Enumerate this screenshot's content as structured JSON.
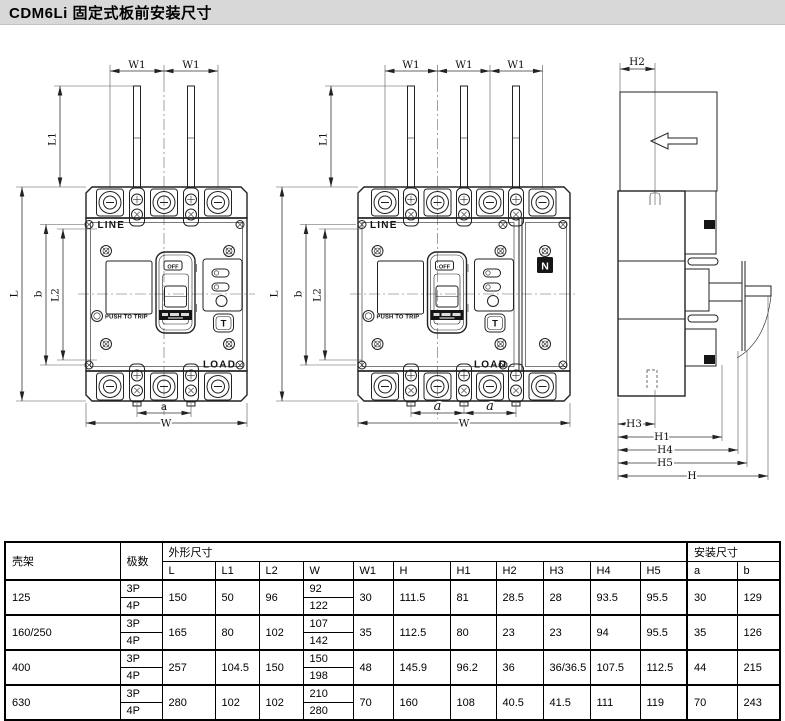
{
  "page": {
    "title": "CDM6Li 固定式板前安装尺寸"
  },
  "drawings": {
    "labels": {
      "line": "LINE",
      "load": "LOAD",
      "push_to_trip": "PUSH TO TRIP",
      "off": "OFF",
      "test": "T"
    },
    "front_3p": {
      "dims": {
        "w1": "W1",
        "l1": "L1",
        "l": "L",
        "b": "b",
        "l2": "L2",
        "a": "a",
        "w": "W"
      }
    },
    "front_4p": {
      "neutral": "N",
      "dims": {
        "w1": "W1",
        "l1": "L1",
        "l": "L",
        "b": "b",
        "l2": "L2",
        "a": "a",
        "w": "W"
      }
    },
    "side": {
      "dims": {
        "h2": "H2",
        "h3": "H3",
        "h1": "H1",
        "h4": "H4",
        "h5": "H5",
        "h": "H"
      }
    }
  },
  "table": {
    "headers": {
      "frame": "壳架",
      "poles": "极数",
      "outline": "外形尺寸",
      "mounting": "安装尺寸",
      "cols": [
        "L",
        "L1",
        "L2",
        "W",
        "W1",
        "H",
        "H1",
        "H2",
        "H3",
        "H4",
        "H5",
        "a",
        "b"
      ]
    },
    "rows": [
      {
        "frame": "125",
        "poles": [
          "3P",
          "4P"
        ],
        "L": "150",
        "L1": "50",
        "L2": "96",
        "W": [
          "92",
          "122"
        ],
        "W1": "30",
        "H": "111.5",
        "H1": "81",
        "H2": "28.5",
        "H3": "28",
        "H4": "93.5",
        "H5": "95.5",
        "a": "30",
        "b": "129"
      },
      {
        "frame": "160/250",
        "poles": [
          "3P",
          "4P"
        ],
        "L": "165",
        "L1": "80",
        "L2": "102",
        "W": [
          "107",
          "142"
        ],
        "W1": "35",
        "H": "112.5",
        "H1": "80",
        "H2": "23",
        "H3": "23",
        "H4": "94",
        "H5": "95.5",
        "a": "35",
        "b": "126"
      },
      {
        "frame": "400",
        "poles": [
          "3P",
          "4P"
        ],
        "L": "257",
        "L1": "104.5",
        "L2": "150",
        "W": [
          "150",
          "198"
        ],
        "W1": "48",
        "H": "145.9",
        "H1": "96.2",
        "H2": "36",
        "H3": "36/36.5",
        "H4": "107.5",
        "H5": "112.5",
        "a": "44",
        "b": "215"
      },
      {
        "frame": "630",
        "poles": [
          "3P",
          "4P"
        ],
        "L": "280",
        "L1": "102",
        "L2": "102",
        "W": [
          "210",
          "280"
        ],
        "W1": "70",
        "H": "160",
        "H1": "108",
        "H2": "40.5",
        "H3": "41.5",
        "H4": "111",
        "H5": "119",
        "a": "70",
        "b": "243"
      }
    ]
  }
}
